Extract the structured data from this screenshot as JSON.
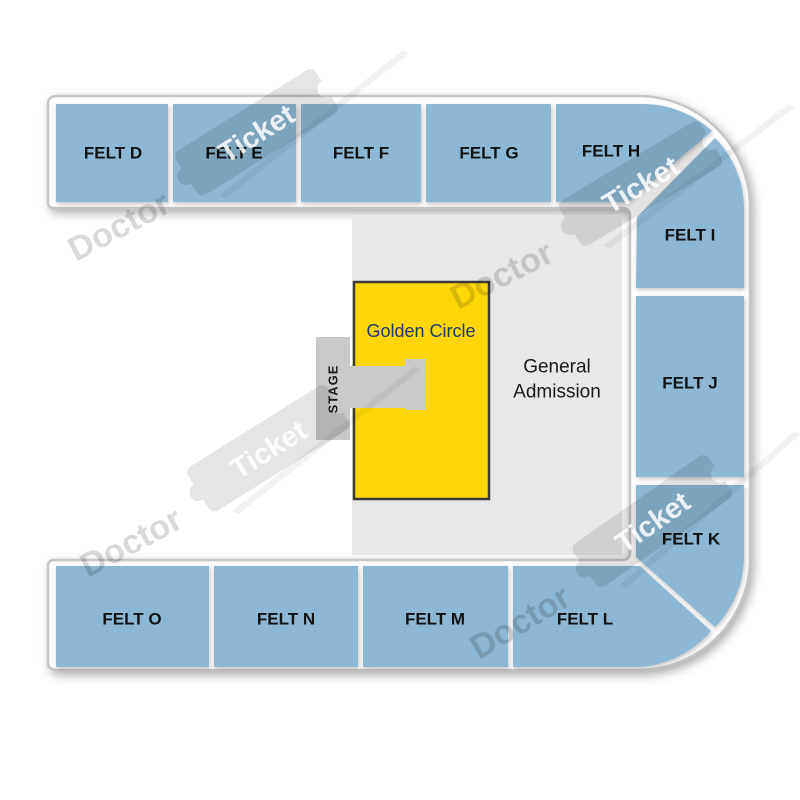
{
  "colors": {
    "section_blue": "#8DB7D2",
    "floor_gray": "#E8E8E8",
    "stage_gray": "#C9C9C9",
    "golden_yellow": "#FFD708",
    "golden_border": "#3A3A3A",
    "golden_text": "#1F3864",
    "band_border": "#C6C6C6"
  },
  "sections": {
    "felt_d": {
      "label": "FELT D"
    },
    "felt_e": {
      "label": "FELT E"
    },
    "felt_f": {
      "label": "FELT F"
    },
    "felt_g": {
      "label": "FELT G"
    },
    "felt_h": {
      "label": "FELT H"
    },
    "felt_i": {
      "label": "FELT I"
    },
    "felt_j": {
      "label": "FELT J"
    },
    "felt_k": {
      "label": "FELT K"
    },
    "felt_l": {
      "label": "FELT L"
    },
    "felt_m": {
      "label": "FELT M"
    },
    "felt_n": {
      "label": "FELT N"
    },
    "felt_o": {
      "label": "FELT O"
    }
  },
  "floor": {
    "general_admission": {
      "line1": "General",
      "line2": "Admission"
    },
    "golden_circle": {
      "label": "Golden Circle"
    },
    "stage": {
      "label": "STAGE"
    }
  },
  "watermark": {
    "doctor": "Doctor",
    "ticket": "Ticket"
  }
}
